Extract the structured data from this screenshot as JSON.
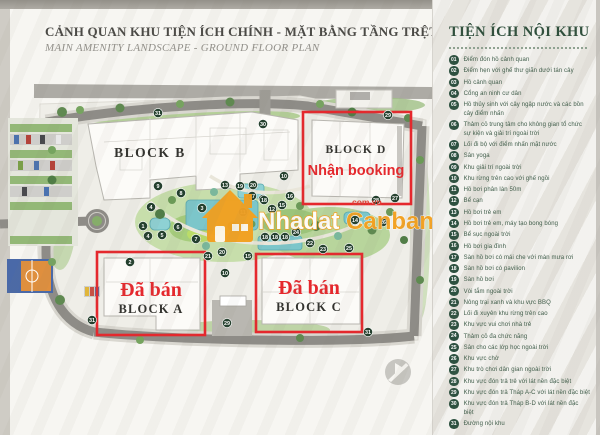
{
  "header": {
    "title_vi": "CẢNH QUAN KHU TIỆN ÍCH CHÍNH - MẶT BẰNG TẦNG TRỆT",
    "title_en": "MAIN AMENITY LANDSCAPE - GROUND FLOOR PLAN"
  },
  "legend": {
    "title": "TIỆN ÍCH NỘI KHU",
    "items": [
      {
        "num": "01",
        "label": "Điểm đón hồ cảnh quan"
      },
      {
        "num": "02",
        "label": "Điểm hẹn với ghế thư giãn dưới tán cây"
      },
      {
        "num": "03",
        "label": "Hồ cảnh quan"
      },
      {
        "num": "04",
        "label": "Cổng an ninh cư dân"
      },
      {
        "num": "05",
        "label": "Hồ thủy sinh với cây ngập nước và các bồn cây điểm nhấn"
      },
      {
        "num": "06",
        "label": "Thảm cỏ trung tâm cho không gian tổ chức sự kiện và giải trí ngoài trời"
      },
      {
        "num": "07",
        "label": "Lối đi bộ với điểm nhấn mặt nước"
      },
      {
        "num": "08",
        "label": "Sân yoga"
      },
      {
        "num": "09",
        "label": "Khu giải trí ngoài trời"
      },
      {
        "num": "10",
        "label": "Khu rừng trên cao với ghế ngồi"
      },
      {
        "num": "11",
        "label": "Hồ bơi phân làn 50m"
      },
      {
        "num": "12",
        "label": "Bể cạn"
      },
      {
        "num": "13",
        "label": "Hồ bơi trẻ em"
      },
      {
        "num": "14",
        "label": "Hồ bơi trẻ em, máy tạo bong bóng"
      },
      {
        "num": "15",
        "label": "Bể sục ngoài trời"
      },
      {
        "num": "16",
        "label": "Hồ bơi gia đình"
      },
      {
        "num": "17",
        "label": "Sàn hồ bơi có mái che với màn mưa rơi"
      },
      {
        "num": "18",
        "label": "Sàn hồ bơi có pavilion"
      },
      {
        "num": "19",
        "label": "Sàn hồ bơi"
      },
      {
        "num": "20",
        "label": "Vòi tắm ngoài trời"
      },
      {
        "num": "21",
        "label": "Nông trại xanh và khu vực BBQ"
      },
      {
        "num": "22",
        "label": "Lối đi xuyên khu rừng trên cao"
      },
      {
        "num": "23",
        "label": "Khu vực vui chơi nhà trẻ"
      },
      {
        "num": "24",
        "label": "Thảm cỏ đa chức năng"
      },
      {
        "num": "25",
        "label": "Sân cho các lớp học ngoài trời"
      },
      {
        "num": "26",
        "label": "Khu vực chờ"
      },
      {
        "num": "27",
        "label": "Khu trò chơi dân gian ngoài trời"
      },
      {
        "num": "28",
        "label": "Khu vực đón trả trẻ với lát nền đặc biệt"
      },
      {
        "num": "29",
        "label": "Khu vực đón trả Tháp A-C với lát nền đặc biệt"
      },
      {
        "num": "30",
        "label": "Khu vực đón trả Tháp B-D với lát nền đặc biệt"
      },
      {
        "num": "31",
        "label": "Đường nội khu"
      }
    ]
  },
  "map": {
    "blocks": {
      "b": "BLOCK B",
      "d": "BLOCK D",
      "a": "BLOCK A",
      "c": "BLOCK C"
    },
    "overlays": {
      "booking": "Nhận booking",
      "sold_a": "Đã bán",
      "sold_c": "Đã bán"
    },
    "watermark": {
      "brand_1": "Nhadat",
      "brand_2": "Canban",
      "domain": "com.vn"
    },
    "markers": [
      {
        "n": "31",
        "x": 158,
        "y": 113
      },
      {
        "n": "30",
        "x": 263,
        "y": 124
      },
      {
        "n": "29",
        "x": 388,
        "y": 115
      },
      {
        "n": "9",
        "x": 158,
        "y": 186
      },
      {
        "n": "8",
        "x": 181,
        "y": 193
      },
      {
        "n": "4",
        "x": 151,
        "y": 207
      },
      {
        "n": "3",
        "x": 202,
        "y": 208
      },
      {
        "n": "6",
        "x": 178,
        "y": 227
      },
      {
        "n": "1",
        "x": 143,
        "y": 226
      },
      {
        "n": "2",
        "x": 130,
        "y": 262
      },
      {
        "n": "4",
        "x": 148,
        "y": 236
      },
      {
        "n": "5",
        "x": 162,
        "y": 235
      },
      {
        "n": "7",
        "x": 196,
        "y": 239
      },
      {
        "n": "13",
        "x": 225,
        "y": 185
      },
      {
        "n": "19",
        "x": 240,
        "y": 186
      },
      {
        "n": "20",
        "x": 253,
        "y": 185
      },
      {
        "n": "10",
        "x": 284,
        "y": 176
      },
      {
        "n": "16",
        "x": 290,
        "y": 196
      },
      {
        "n": "17",
        "x": 252,
        "y": 196
      },
      {
        "n": "19",
        "x": 263,
        "y": 199
      },
      {
        "n": "12",
        "x": 272,
        "y": 209
      },
      {
        "n": "15",
        "x": 282,
        "y": 205
      },
      {
        "n": "11",
        "x": 243,
        "y": 212
      },
      {
        "n": "14",
        "x": 355,
        "y": 220
      },
      {
        "n": "18",
        "x": 264,
        "y": 200
      },
      {
        "n": "18",
        "x": 265,
        "y": 237
      },
      {
        "n": "18",
        "x": 275,
        "y": 237
      },
      {
        "n": "18",
        "x": 285,
        "y": 237
      },
      {
        "n": "20",
        "x": 222,
        "y": 252
      },
      {
        "n": "15",
        "x": 248,
        "y": 256
      },
      {
        "n": "10",
        "x": 225,
        "y": 273
      },
      {
        "n": "21",
        "x": 208,
        "y": 256
      },
      {
        "n": "24",
        "x": 296,
        "y": 232
      },
      {
        "n": "22",
        "x": 310,
        "y": 243
      },
      {
        "n": "23",
        "x": 323,
        "y": 249
      },
      {
        "n": "25",
        "x": 349,
        "y": 248
      },
      {
        "n": "26",
        "x": 383,
        "y": 222
      },
      {
        "n": "27",
        "x": 395,
        "y": 198
      },
      {
        "n": "28",
        "x": 376,
        "y": 200
      },
      {
        "n": "29",
        "x": 227,
        "y": 323
      },
      {
        "n": "31",
        "x": 92,
        "y": 320
      },
      {
        "n": "31",
        "x": 368,
        "y": 332
      }
    ]
  },
  "colors": {
    "accent_red": "#e5282d",
    "legend_green": "#2d5140",
    "marker_green": "#24402e",
    "watermark_orange": "#f3a120",
    "pool_teal": "#7cc6ca"
  }
}
